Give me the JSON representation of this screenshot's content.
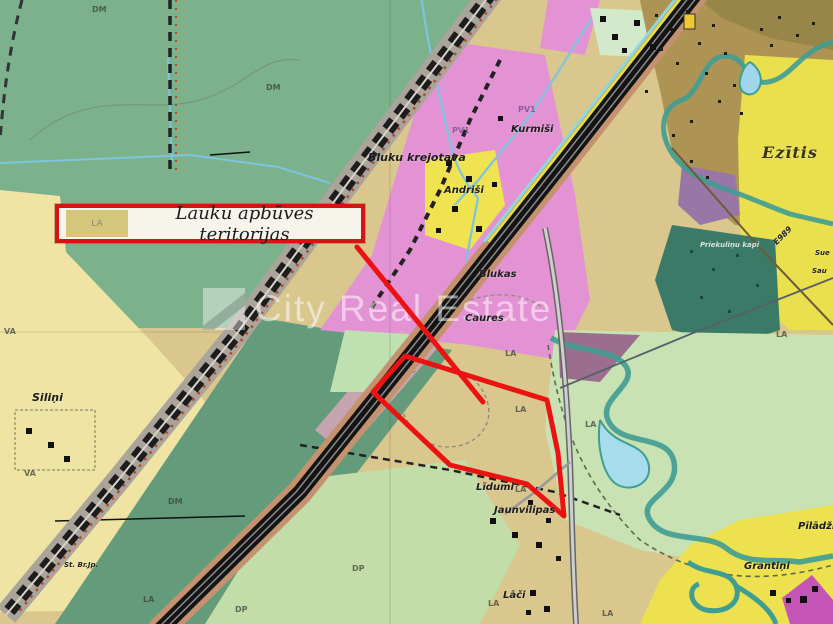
{
  "legend": {
    "code": "LA",
    "label": "Lauku apbūves teritorijas"
  },
  "watermark": {
    "brand": "City Real Estate"
  },
  "places": {
    "bluku_krejotava": "Bluku krejotava",
    "kurmisi": "Kurmiši",
    "andrisi": "Andriši",
    "blukas": "Blukas",
    "caures": "Caures",
    "silini": "Siliņi",
    "lidumi": "Līdumi",
    "jaunvilipas": "Jaunvilipas",
    "laci": "Lāči",
    "grantini": "Grantiņi",
    "piladzi": "Pīlādži",
    "ezitis": "Ezītis",
    "kapi": "Priekuliņu kapi",
    "br_jp": "St. Br.Jp.",
    "road_code": "E989",
    "edge_1": "Sue",
    "edge_2": "Sau"
  },
  "zone_codes": {
    "dm_1": "DM",
    "dm_2": "DM",
    "dm_3": "DM",
    "va_1": "VA",
    "va_2": "VA",
    "la_1": "LA",
    "la_2": "LA",
    "la_3": "LA",
    "la_4": "LA",
    "la_5": "LA",
    "la_6": "LA",
    "la_7": "LA",
    "la_8": "LA",
    "dp_1": "DP",
    "dp_2": "DP",
    "pv1_1": "PV1",
    "pv1_2": "PV1"
  },
  "colors": {
    "annotation_red": "#EC1212",
    "legend_border_red": "#D61414",
    "legend_swatch_tan": "#D4C77C",
    "zone_pink": "#E393D4",
    "zone_green": "#7BB28C",
    "zone_tan": "#D9C78E",
    "zone_yellow": "#EAE04E",
    "water_teal": "#3F9D92"
  }
}
